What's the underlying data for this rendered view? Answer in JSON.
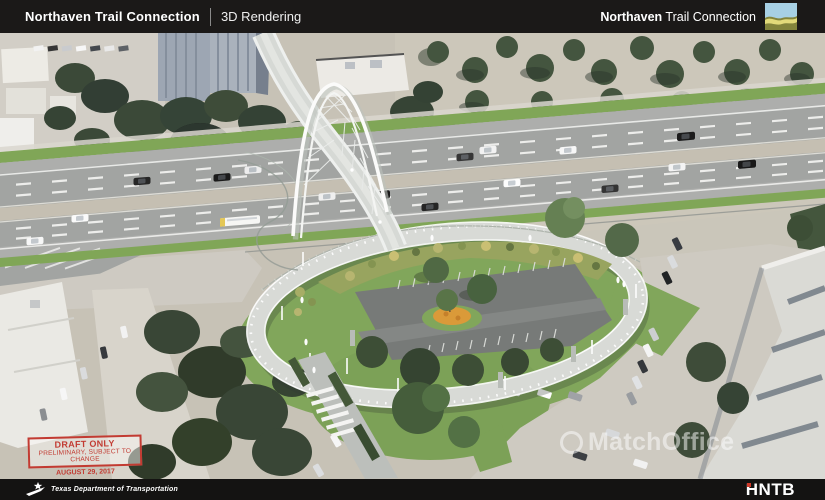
{
  "header": {
    "project_title": "Northaven Trail Connection",
    "view_label": "3D Rendering",
    "right_brand_bold": "Northaven",
    "right_brand_rest": " Trail Connection"
  },
  "stamp": {
    "line1": "DRAFT ONLY",
    "line2": "PRELIMINARY, SUBJECT TO CHANGE",
    "date": "AUGUST 29, 2017"
  },
  "watermark": {
    "text": "MatchOffice"
  },
  "footer": {
    "agency": "Texas Department of Transportation",
    "firm": "HNTB"
  },
  "scene": {
    "description": "Aerial 3D rendering of the Northaven Trail pedestrian arch bridge crossing a multi-lane highway, with a spiral ramp loop enclosing a landscaped parking lot, lawns, crosswalk and surrounding buildings",
    "colors": {
      "header_bg": "#1b1918",
      "footer_bg": "#141312",
      "stamp_red": "#c23b32",
      "logo_sky": "#a7d0e4",
      "logo_hill_dark": "#83843c",
      "logo_hill_light": "#e7de7d",
      "hntb_red": "#cf3a2a",
      "grass": "#7aa24f",
      "road": "#9da09e",
      "median": "#c2bcae",
      "ramp": "#d6d8d4",
      "parking": "#707371",
      "shrubs": "#93a057",
      "orange_planting": "#d9952f",
      "ground_tan": "#c5bfb3"
    }
  }
}
